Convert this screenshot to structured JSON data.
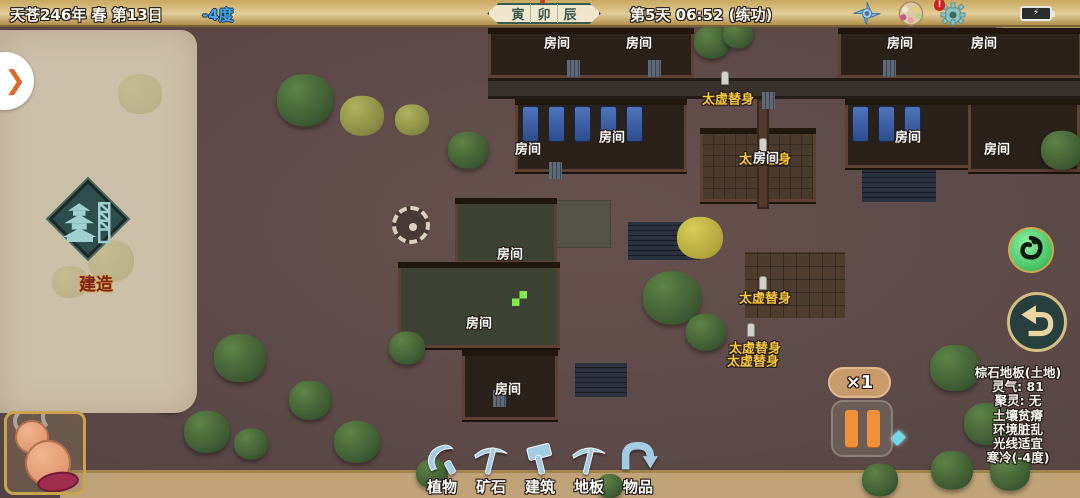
{
  "top_bar": {
    "date": "天苍246年 春 第13日",
    "temperature": "-4度",
    "time_slots": [
      "寅",
      "卯",
      "辰"
    ],
    "active_slot": "卯",
    "session": "第5天 06:52 (练功)",
    "battery_glyph": "⚡",
    "gear_alert": "!"
  },
  "left_panel": {
    "expand_chevron": "❯",
    "build_label": "建造"
  },
  "map": {
    "room_label": "房间",
    "avatar_label": "太虚替身",
    "rooms": [
      [
        557,
        42
      ],
      [
        639,
        42
      ],
      [
        900,
        42
      ],
      [
        984,
        42
      ],
      [
        612,
        136
      ],
      [
        908,
        136
      ],
      [
        528,
        148
      ],
      [
        997,
        148
      ],
      [
        510,
        253
      ],
      [
        479,
        322
      ],
      [
        508,
        388
      ],
      [
        766,
        157
      ]
    ],
    "avatars": [
      [
        728,
        98
      ],
      [
        765,
        158
      ],
      [
        765,
        297
      ],
      [
        755,
        347
      ],
      [
        753,
        360
      ]
    ],
    "sprites": [
      [
        725,
        78
      ],
      [
        763,
        145
      ],
      [
        763,
        283
      ],
      [
        751,
        330
      ]
    ],
    "buildings": [
      {
        "x": 488,
        "y": 28,
        "w": 206,
        "h": 50,
        "k": "plain"
      },
      {
        "x": 838,
        "y": 28,
        "w": 244,
        "h": 50,
        "k": "plain"
      },
      {
        "x": 488,
        "y": 78,
        "w": 594,
        "h": 21,
        "k": "road"
      },
      {
        "x": 515,
        "y": 99,
        "w": 172,
        "h": 73,
        "k": "dorm",
        "beds": 5
      },
      {
        "x": 845,
        "y": 99,
        "w": 126,
        "h": 69,
        "k": "dorm",
        "beds": 3
      },
      {
        "x": 968,
        "y": 99,
        "w": 112,
        "h": 73,
        "k": "plain"
      },
      {
        "x": 700,
        "y": 128,
        "w": 116,
        "h": 74,
        "k": "yard"
      },
      {
        "x": 455,
        "y": 198,
        "w": 102,
        "h": 66,
        "k": "plain2"
      },
      {
        "x": 398,
        "y": 262,
        "w": 162,
        "h": 86,
        "k": "workshop"
      },
      {
        "x": 462,
        "y": 350,
        "w": 96,
        "h": 70,
        "k": "plain"
      },
      {
        "x": 757,
        "y": 99,
        "w": 12,
        "h": 110,
        "k": "wall"
      }
    ],
    "plots": [
      [
        628,
        222,
        72,
        38,
        "navy"
      ],
      [
        862,
        156,
        74,
        46,
        "navy"
      ],
      [
        553,
        200,
        58,
        48,
        "gray"
      ],
      [
        745,
        252,
        100,
        66,
        "brown"
      ],
      [
        575,
        363,
        52,
        34,
        "navy"
      ]
    ],
    "gates": [
      [
        567,
        60
      ],
      [
        648,
        60
      ],
      [
        883,
        60
      ],
      [
        762,
        92
      ],
      [
        549,
        162
      ],
      [
        493,
        390
      ]
    ],
    "trees": [
      [
        305,
        100,
        56,
        "pine"
      ],
      [
        362,
        116,
        44,
        "olive"
      ],
      [
        468,
        150,
        40,
        "pine"
      ],
      [
        412,
        120,
        34,
        "olive"
      ],
      [
        240,
        358,
        52,
        "pine"
      ],
      [
        170,
        392,
        42,
        "pine"
      ],
      [
        207,
        432,
        46,
        "pine"
      ],
      [
        310,
        400,
        42,
        "pine"
      ],
      [
        357,
        442,
        46,
        "pine"
      ],
      [
        407,
        348,
        36,
        "pine"
      ],
      [
        251,
        444,
        34,
        "pine"
      ],
      [
        672,
        298,
        58,
        "pine"
      ],
      [
        700,
        238,
        46,
        "yellow"
      ],
      [
        706,
        332,
        40,
        "pine"
      ],
      [
        712,
        42,
        36,
        "pine"
      ],
      [
        738,
        34,
        30,
        "pine"
      ],
      [
        955,
        368,
        50,
        "pine"
      ],
      [
        987,
        424,
        46,
        "pine"
      ],
      [
        952,
        470,
        42,
        "pine"
      ],
      [
        1010,
        472,
        40,
        "pine"
      ],
      [
        880,
        480,
        36,
        "pine"
      ],
      [
        432,
        474,
        32,
        "pine"
      ],
      [
        610,
        486,
        26,
        "pine"
      ],
      [
        1062,
        150,
        42,
        "pine"
      ]
    ]
  },
  "controls": {
    "speed_label": "×1"
  },
  "tile_info": {
    "title": "棕石地板(土地)",
    "lines": [
      "灵气: 81",
      "聚灵: 无",
      "土壤贫瘠",
      "环境脏乱",
      "光线适宜",
      "寒冷(-4度)"
    ]
  },
  "toolbar": {
    "items": [
      {
        "label": "植物",
        "icon": "sickle-icon"
      },
      {
        "label": "矿石",
        "icon": "pickaxe-icon"
      },
      {
        "label": "建筑",
        "icon": "hammer-icon"
      },
      {
        "label": "地板",
        "icon": "pickaxe-icon"
      },
      {
        "label": "物品",
        "icon": "return-arrow-icon"
      }
    ]
  },
  "colors": {
    "accent_gold": "#f8c83e",
    "ground": "#5e4b48",
    "topbar_gold": "#d9c48c",
    "panel_beige": "#ccbfa8",
    "pause_orange": "#f0913a",
    "toolbar_blue": "#a3cbe3",
    "temp_blue": "#46a5e8"
  }
}
